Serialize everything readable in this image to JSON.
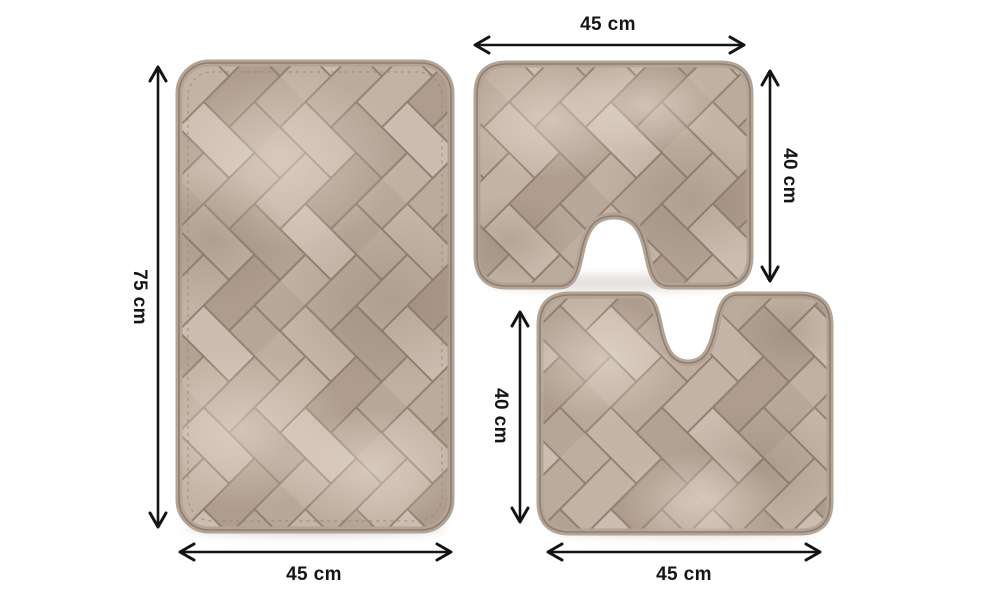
{
  "diagram": {
    "description_type": "product-dimension-diagram",
    "background": "#ffffff",
    "mats": {
      "bath_mat": {
        "shape": "rectangle",
        "width_label": "45 cm",
        "height_label": "75 cm"
      },
      "pedestal_mat_top": {
        "shape": "contour-u-notch-bottom",
        "width_label": "45 cm",
        "height_label": "40 cm"
      },
      "pedestal_mat_bottom": {
        "shape": "contour-u-notch-top",
        "width_label": "45 cm",
        "height_label": "40 cm"
      }
    },
    "icons": {
      "dimension_arrow": "double-headed-line-arrow"
    },
    "colors": {
      "arrow": "#141414",
      "label_text": "#151515",
      "mat_base": "#b7a89a",
      "mat_light": "#cfc1b3",
      "mat_dark": "#a59484",
      "groove": "#8a7a6b",
      "binding": "#b3a496",
      "edge_line": "#8f7e6f",
      "background": "#ffffff"
    }
  }
}
